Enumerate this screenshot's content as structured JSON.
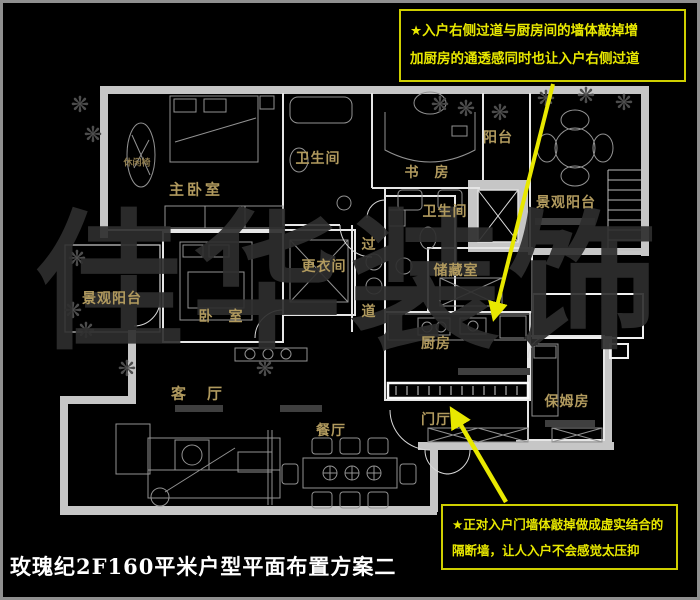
{
  "title": "玫瑰纪2F160平米户型平面布置方案二",
  "watermark": {
    "char1": "佳",
    "char2": "华",
    "char3": "装",
    "char4": "饰"
  },
  "annotations": {
    "top": {
      "lines": [
        "★入户右侧过道与厨房间的墙体敲掉增",
        "加厨房的通透感同时也让入户右侧过道"
      ]
    },
    "bottom": {
      "lines": [
        "★正对入户门墙体敲掉做成虚实结合的",
        "隔断墙，让人入户不会感觉太压抑"
      ]
    }
  },
  "rooms": {
    "master_bedroom": "主卧室",
    "master_bath": "卫生间",
    "study": "书　房",
    "balcony_top": "阳台",
    "scenic_balcony_right": "景观阳台",
    "hall_bath": "卫生间",
    "corridor_char1": "过",
    "corridor_char2": "道",
    "storage": "储藏室",
    "kitchen": "厨房",
    "dressing_room": "更衣间",
    "bedroom2": "卧　室",
    "scenic_balcony_left": "景观阳台",
    "living_room": "客　厅",
    "dining_room": "餐厅",
    "foyer": "门厅",
    "nanny_room": "保姆房",
    "leisure_chair": "休闲椅"
  },
  "colors": {
    "background": "#000000",
    "wall_gray": "#c6c6c6",
    "line_white": "#e6e6e6",
    "label_gold": "#b19a5e",
    "annotation_yellow": "#e8e800",
    "frame_gray": "#8f8f8f"
  }
}
